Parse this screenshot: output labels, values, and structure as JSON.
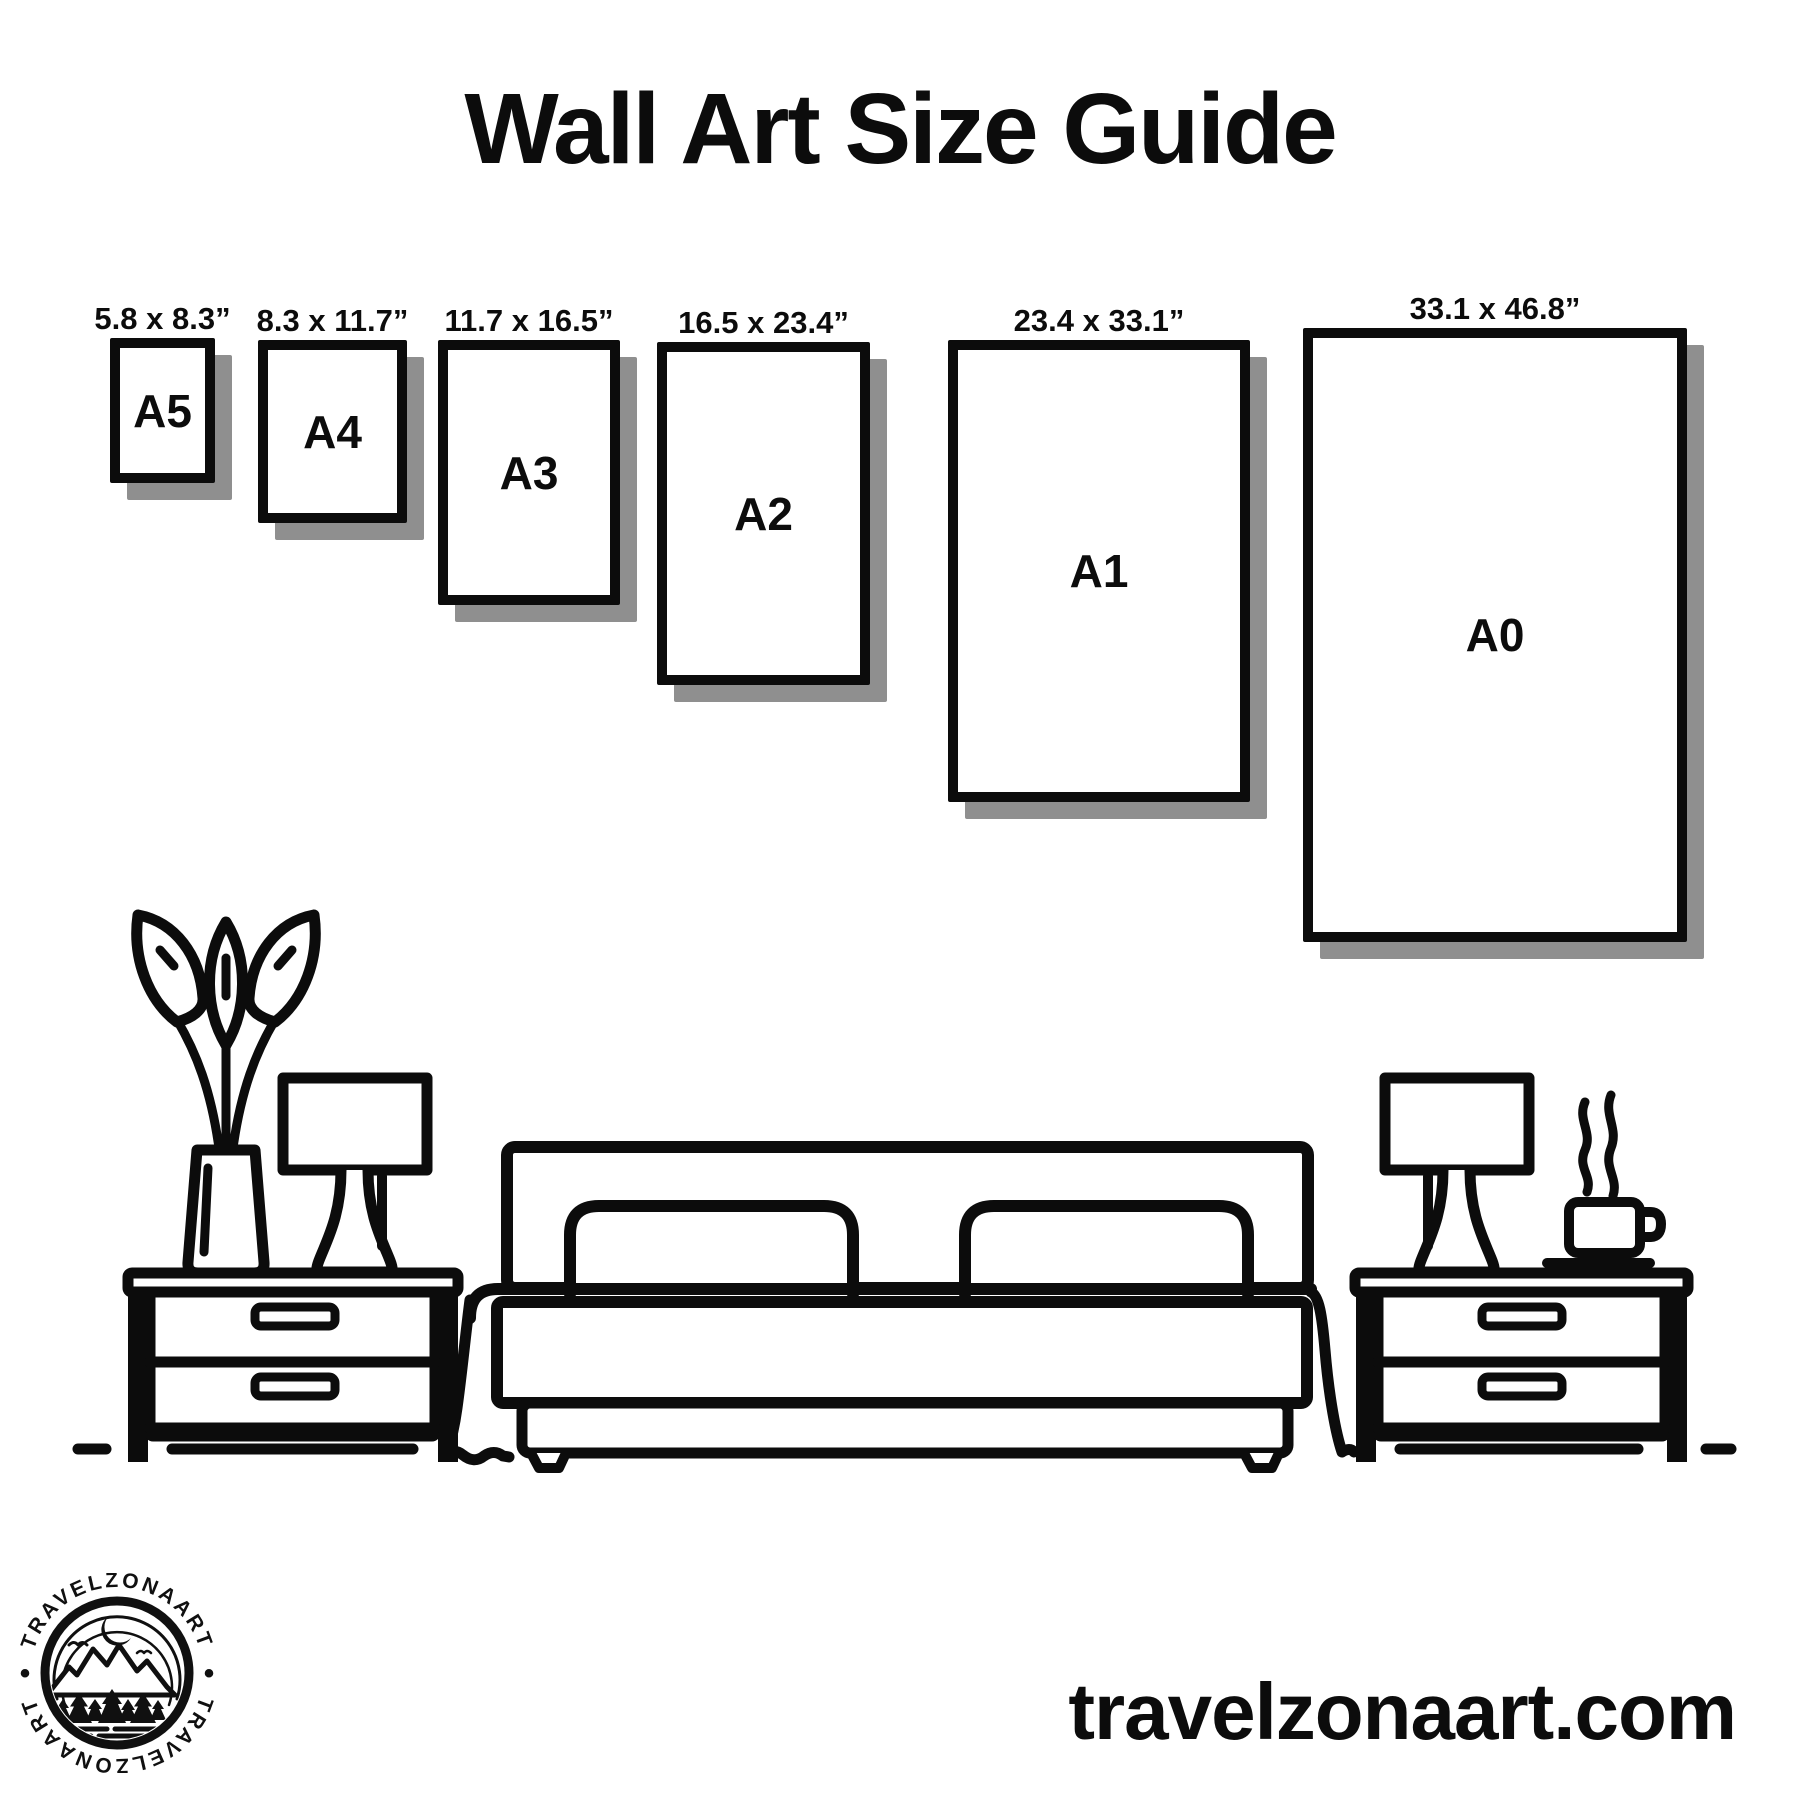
{
  "title": "Wall Art Size Guide",
  "frames": [
    {
      "name": "A5",
      "size": "5.8 x 8.3”"
    },
    {
      "name": "A4",
      "size": "8.3 x 11.7”"
    },
    {
      "name": "A3",
      "size": "11.7 x 16.5”"
    },
    {
      "name": "A2",
      "size": "16.5 x 23.4”"
    },
    {
      "name": "A1",
      "size": "23.4 x 33.1”"
    },
    {
      "name": "A0",
      "size": "33.1 x 46.8”"
    }
  ],
  "footer": {
    "website": "travelzonaart.com"
  },
  "logo": {
    "arc_text_top": "TRAVELZONAART",
    "arc_text_bottom": "TRAVELZONAART",
    "separator": "•"
  },
  "colors": {
    "ink": "#0c0c0c",
    "shadow": "#8f8f8f",
    "background": "#ffffff"
  }
}
